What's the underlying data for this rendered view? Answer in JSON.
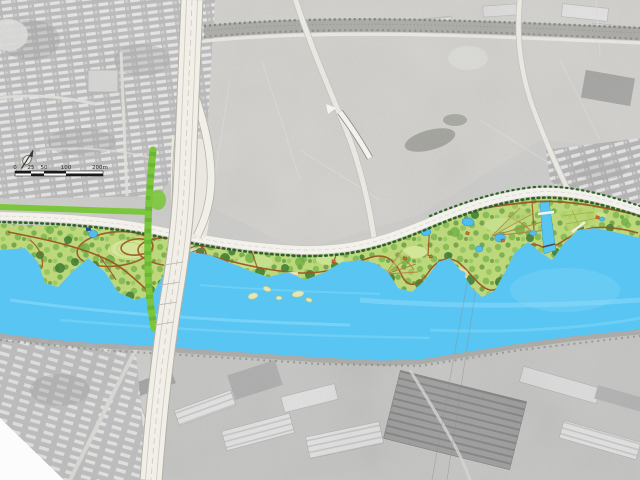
{
  "map": {
    "type": "riverfront-park-masterplan-over-grayscale-aerial-photo",
    "scale_bar": {
      "unit": "m",
      "labels": [
        "0",
        "25",
        "50",
        "100",
        "200m"
      ]
    },
    "north_arrow": {
      "present": true
    },
    "colors": {
      "river_water": "#58c5f3",
      "water_highlight": "#8fdcf9",
      "park_base_green": "#bcd87b",
      "canopy_dark_green": "#3e7c33",
      "canopy_mid_green": "#6fae45",
      "lawn_light_green": "#d2e598",
      "footpath_brown": "#9c5a26",
      "highway_verge_green": "#7cc63c",
      "road_surface": "#f2f0ea",
      "pavilion_roof_orange": "#d2722a",
      "sand_beach": "#e9dfb4",
      "aerial_photo_gray": "#cdcdcb"
    },
    "features": {
      "river": "blue river running west-east through center",
      "park": "designed green park band along north bank",
      "highway_bridge": "elevated highway crossing river at west",
      "riverside_road": "tree-lined road along north edge of park",
      "rail_corridor": "rail/road corridor across top",
      "industrial_south": "warehouse district on south bank",
      "residential_northwest": "dense housing blocks top-left",
      "residential_east": "housing rows at right edge",
      "islands": "small islets in mid-channel",
      "creek_inlet": "creek joining river on east section"
    }
  }
}
